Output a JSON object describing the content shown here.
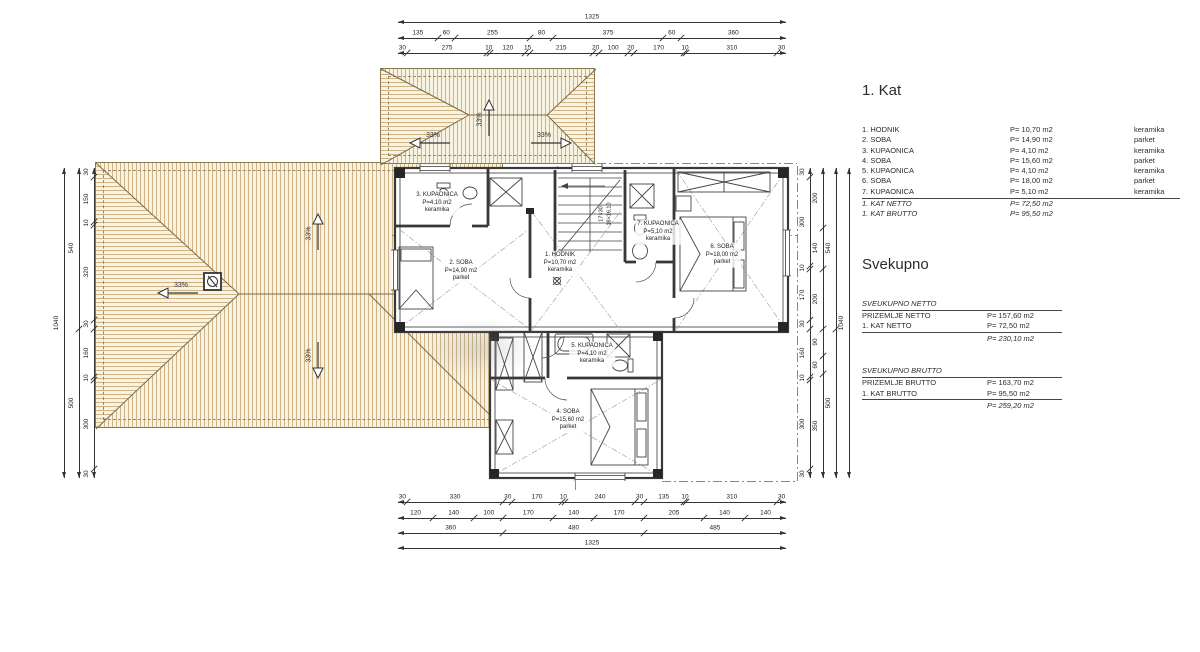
{
  "legend": {
    "title": "1. Kat",
    "rows": [
      {
        "name": "1. HODNIK",
        "area": "P= 10,70 m2",
        "material": "keramika"
      },
      {
        "name": "2. SOBA",
        "area": "P= 14,90 m2",
        "material": "parket"
      },
      {
        "name": "3. KUPAONICA",
        "area": "P= 4,10 m2",
        "material": "keramika"
      },
      {
        "name": "4. SOBA",
        "area": "P= 15,60 m2",
        "material": "parket"
      },
      {
        "name": "5. KUPAONICA",
        "area": "P= 4,10 m2",
        "material": "keramika"
      },
      {
        "name": "6. SOBA",
        "area": "P= 18,00 m2",
        "material": "parket"
      },
      {
        "name": "7. KUPAONICA",
        "area": "P= 5,10 m2",
        "material": "keramika"
      }
    ],
    "totals": [
      {
        "name": "1. KAT NETTO",
        "area": "P= 72,50 m2"
      },
      {
        "name": "1. KAT BRUTTO",
        "area": "P= 95,50 m2"
      }
    ]
  },
  "summary": {
    "title": "Svekupno",
    "netto": {
      "heading": "SVEUKUPNO NETTO",
      "rows": [
        {
          "name": "PRIZEMLJE NETTO",
          "area": "P= 157,60 m2"
        },
        {
          "name": "1. KAT NETTO",
          "area": "P= 72,50 m2"
        }
      ],
      "total": "P= 230,10 m2"
    },
    "brutto": {
      "heading": "SVEUKUPNO BRUTTO",
      "rows": [
        {
          "name": "PRIZEMLJE BRUTTO",
          "area": "P= 163,70 m2"
        },
        {
          "name": "1. KAT BRUTTO",
          "area": "P= 95,50 m2"
        }
      ],
      "total": "P= 259,20 m2"
    }
  },
  "rooms": [
    {
      "name": "3. KUPAONICA",
      "area": "P=4,10 m2",
      "floor": "keramika",
      "x": 437,
      "y": 203
    },
    {
      "name": "2. SOBA",
      "area": "P=14,90 m2",
      "floor": "parket",
      "x": 461,
      "y": 271
    },
    {
      "name": "1. HODNIK",
      "area": "P=10,70 m2",
      "floor": "keramika",
      "x": 560,
      "y": 263
    },
    {
      "name": "7. KUPAONICA",
      "area": "P=5,10 m2",
      "floor": "keramika",
      "x": 658,
      "y": 232
    },
    {
      "name": "6. SOBA",
      "area": "P=18,00 m2",
      "floor": "parket",
      "x": 722,
      "y": 255
    },
    {
      "name": "5. KUPAONICA",
      "area": "P=4,10 m2",
      "floor": "keramika",
      "x": 592,
      "y": 354
    },
    {
      "name": "4. SOBA",
      "area": "P=15,60 m2",
      "floor": "parket",
      "x": 568,
      "y": 420
    }
  ],
  "stairs": {
    "line1": "17×30",
    "line2": "18×16,10"
  },
  "roof": {
    "slope_label": "33%",
    "arrows": [
      {
        "dir": "left",
        "x": 178,
        "y": 293
      },
      {
        "dir": "up",
        "x": 318,
        "y": 232
      },
      {
        "dir": "down",
        "x": 318,
        "y": 360
      },
      {
        "dir": "left",
        "x": 430,
        "y": 143
      },
      {
        "dir": "up",
        "x": 489,
        "y": 118
      },
      {
        "dir": "right",
        "x": 551,
        "y": 143
      }
    ]
  },
  "dimensions": {
    "top": {
      "x0": 398,
      "x1": 786,
      "rows": [
        {
          "y": 22,
          "segments": [
            1325
          ]
        },
        {
          "y": 38,
          "segments": [
            135,
            60,
            255,
            80,
            375,
            60,
            360
          ]
        },
        {
          "y": 53,
          "segments": [
            30,
            275,
            10,
            120,
            15,
            215,
            20,
            100,
            20,
            170,
            10,
            310,
            30
          ]
        }
      ]
    },
    "bottom": {
      "x0": 398,
      "x1": 786,
      "rows": [
        {
          "y": 502,
          "segments": [
            30,
            330,
            30,
            170,
            10,
            240,
            30,
            135,
            10,
            310,
            30
          ]
        },
        {
          "y": 518,
          "segments": [
            120,
            140,
            100,
            170,
            140,
            170,
            205,
            140,
            140
          ]
        },
        {
          "y": 533,
          "segments": [
            360,
            480,
            485
          ]
        },
        {
          "y": 548,
          "segments": [
            1325
          ]
        }
      ]
    },
    "left": {
      "y0": 168,
      "y1": 478,
      "cols": [
        {
          "x": 64,
          "segments": [
            1040
          ]
        },
        {
          "x": 79,
          "segments": [
            540,
            500
          ]
        },
        {
          "x": 94,
          "segments": [
            30,
            150,
            10,
            320,
            30,
            160,
            10,
            300,
            30
          ]
        }
      ]
    },
    "right": {
      "y0": 168,
      "y1": 478,
      "cols": [
        {
          "x": 810,
          "segments": [
            30,
            300,
            10,
            170,
            30,
            160,
            10,
            300,
            30
          ]
        },
        {
          "x": 823,
          "segments": [
            200,
            140,
            200,
            90,
            60,
            350
          ]
        },
        {
          "x": 836,
          "segments": [
            540,
            500
          ]
        },
        {
          "x": 849,
          "segments": [
            1040
          ]
        }
      ]
    }
  }
}
